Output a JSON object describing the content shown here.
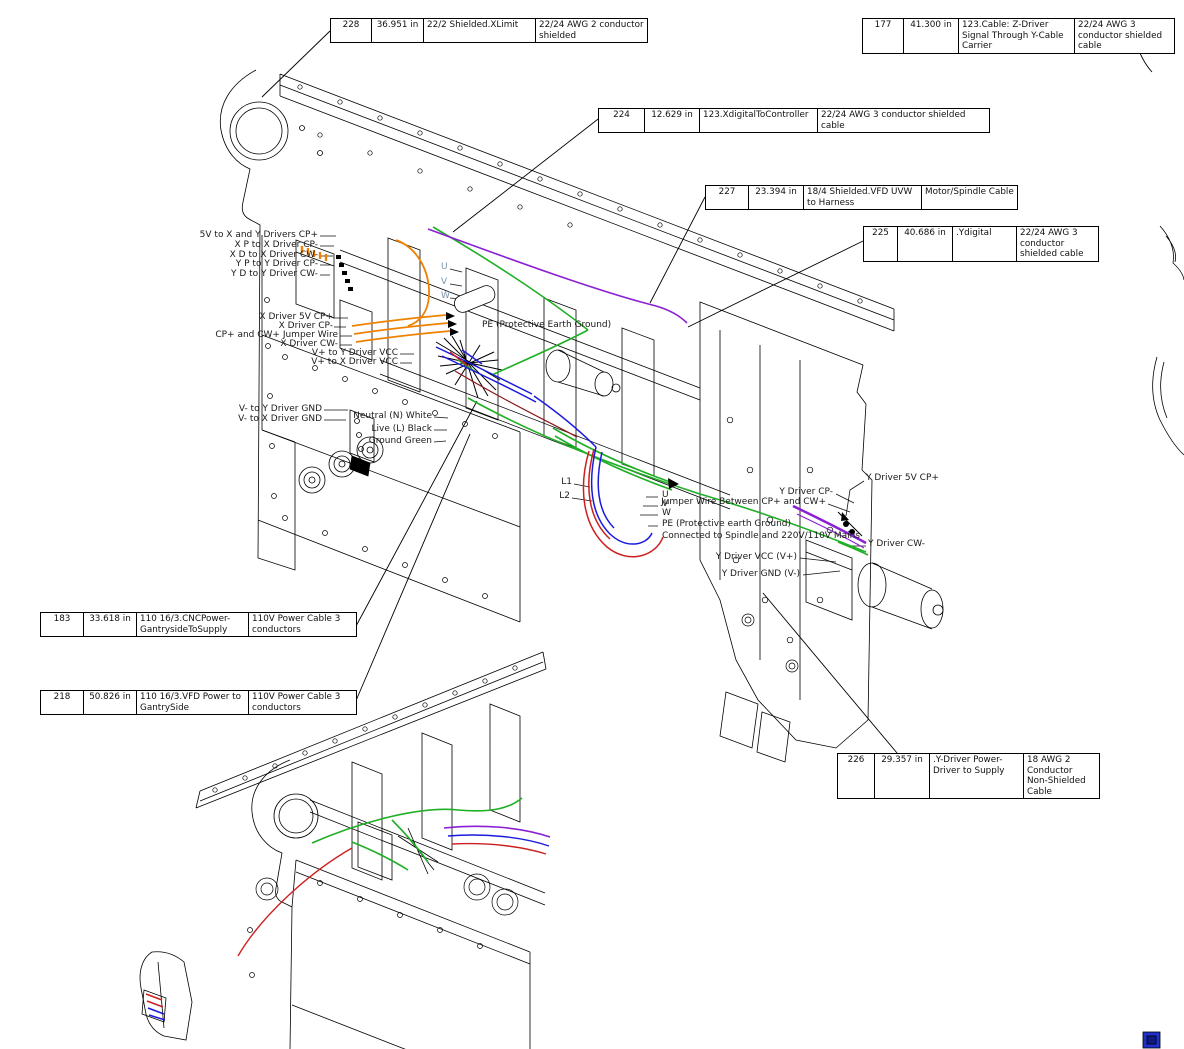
{
  "drawing": {
    "background": "#ffffff",
    "type": "CNC gantry wiring harness diagram, two isometric views"
  },
  "colors": {
    "wire_orange": "#ee8200",
    "wire_green": "#1faf25",
    "wire_purple": "#8a1fd4",
    "wire_blue": "#1a1adf",
    "wire_red": "#cc2020",
    "wire_dark_red": "#8b1a1a",
    "line_black": "#000000",
    "uvw_label_color": "#7a93a8"
  },
  "callouts": [
    {
      "id": "228",
      "length": "36.951 in",
      "cable": "22/2 Shielded.XLimit",
      "spec": "22/24 AWG 2 conductor shielded"
    },
    {
      "id": "177",
      "length": "41.300 in",
      "cable": "123.Cable: Z-Driver Signal Through Y-Cable Carrier",
      "spec": "22/24 AWG 3 conductor shielded cable"
    },
    {
      "id": "224",
      "length": "12.629 in",
      "cable": "123.XdigitalToController",
      "spec": "22/24 AWG 3 conductor shielded cable"
    },
    {
      "id": "227",
      "length": "23.394 in",
      "cable": "18/4 Shielded.VFD UVW to Harness",
      "spec": "Motor/Spindle Cable"
    },
    {
      "id": "225",
      "length": "40.686 in",
      "cable": ".Ydigital",
      "spec": "22/24 AWG 3 conductor shielded cable"
    },
    {
      "id": "183",
      "length": "33.618 in",
      "cable": "110 16/3.CNCPower-GantrysideToSupply",
      "spec": "110V Power Cable 3 conductors"
    },
    {
      "id": "218",
      "length": "50.826 in",
      "cable": "110 16/3.VFD Power to GantrySide",
      "spec": "110V Power Cable 3 conductors"
    },
    {
      "id": "226",
      "length": "29.357 in",
      "cable": ".Y-Driver Power-Driver to Supply",
      "spec": "18 AWG 2 Conductor Non-Shielded Cable"
    }
  ],
  "wire_labels": [
    {
      "text": "5V to X and Y Drivers CP+"
    },
    {
      "text": "X P to X Driver CP-"
    },
    {
      "text": "X D to X Driver CW-"
    },
    {
      "text": "Y P to Y Driver CP-"
    },
    {
      "text": "Y D to Y Driver CW-"
    },
    {
      "text": "X Driver 5V CP+"
    },
    {
      "text": "X Driver CP-"
    },
    {
      "text": "CP+ and CW+ Jumper Wire"
    },
    {
      "text": "X Driver CW-"
    },
    {
      "text": "V+ to Y Driver VCC"
    },
    {
      "text": "V+ to X Driver VCC"
    },
    {
      "text": "V- to Y Driver GND"
    },
    {
      "text": "V- to X Driver GND"
    },
    {
      "text": "Neutral (N) White"
    },
    {
      "text": "Live (L) Black"
    },
    {
      "text": "Ground Green"
    },
    {
      "text": "U"
    },
    {
      "text": "V"
    },
    {
      "text": "W"
    },
    {
      "text": "PE (Protective Earth Ground)"
    },
    {
      "text": "L1"
    },
    {
      "text": "L2"
    },
    {
      "text": "U"
    },
    {
      "text": "V"
    },
    {
      "text": "W"
    },
    {
      "text": "PE (Protective earth Ground)"
    },
    {
      "text": "Connected to Spindle and 220V/110V Mains"
    },
    {
      "text": "Y Driver CP-"
    },
    {
      "text": "Jumper Wire Between CP+ and CW+"
    },
    {
      "text": "Y Driver 5V CP+"
    },
    {
      "text": "Y Driver CW-"
    },
    {
      "text": "Y Driver VCC (V+)"
    },
    {
      "text": "Y Driver GND (V-)"
    }
  ]
}
